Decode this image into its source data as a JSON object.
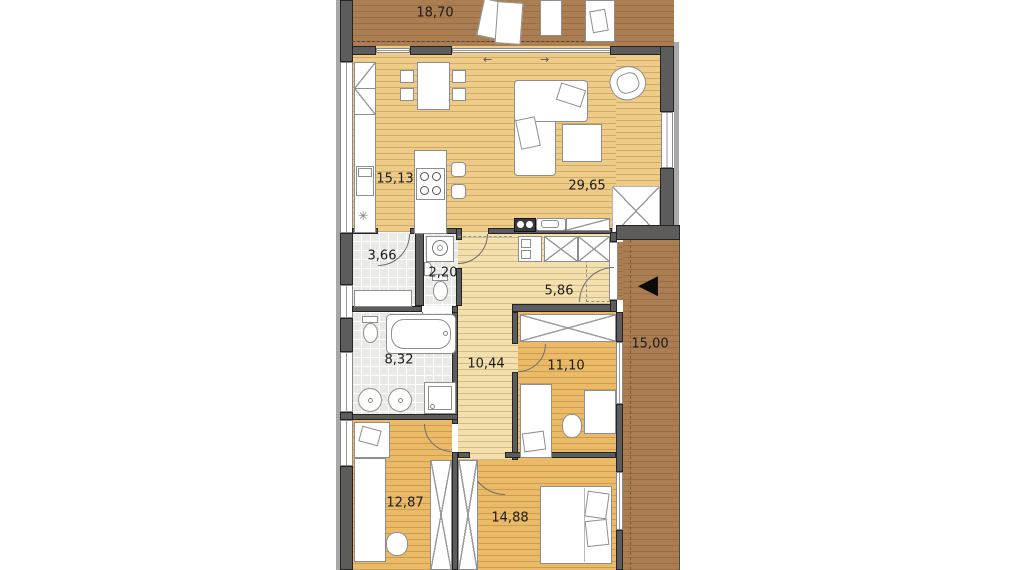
{
  "title": "bungalow-floor-plan",
  "rooms": [
    {
      "name": "terrace",
      "area": "18,70"
    },
    {
      "name": "kitchen",
      "area": "15,13"
    },
    {
      "name": "living-room",
      "area": "29,65"
    },
    {
      "name": "pantry",
      "area": "3,66"
    },
    {
      "name": "wc",
      "area": "2,20"
    },
    {
      "name": "entrance-hall",
      "area": "5,86"
    },
    {
      "name": "bathroom",
      "area": "8,32"
    },
    {
      "name": "corridor",
      "area": "10,44"
    },
    {
      "name": "bedroom-1",
      "area": "11,10"
    },
    {
      "name": "porch",
      "area": "15,00"
    },
    {
      "name": "bedroom-2",
      "area": "12,87"
    },
    {
      "name": "bedroom-3",
      "area": "14,88"
    }
  ],
  "icons": {
    "entrance_arrow": "◀",
    "slide_left": "←",
    "slide_right": "→",
    "sink_symbol": "✳"
  },
  "colors": {
    "wall": "#5c5c5c",
    "wall_outer": "#a8a8a8",
    "terrace_floor": "#aa7e52",
    "living_floor": "#eecb86",
    "bedroom_floor": "#eaba66",
    "corridor_floor": "#f4e0ac",
    "tile_floor": "#e9e9e6"
  }
}
